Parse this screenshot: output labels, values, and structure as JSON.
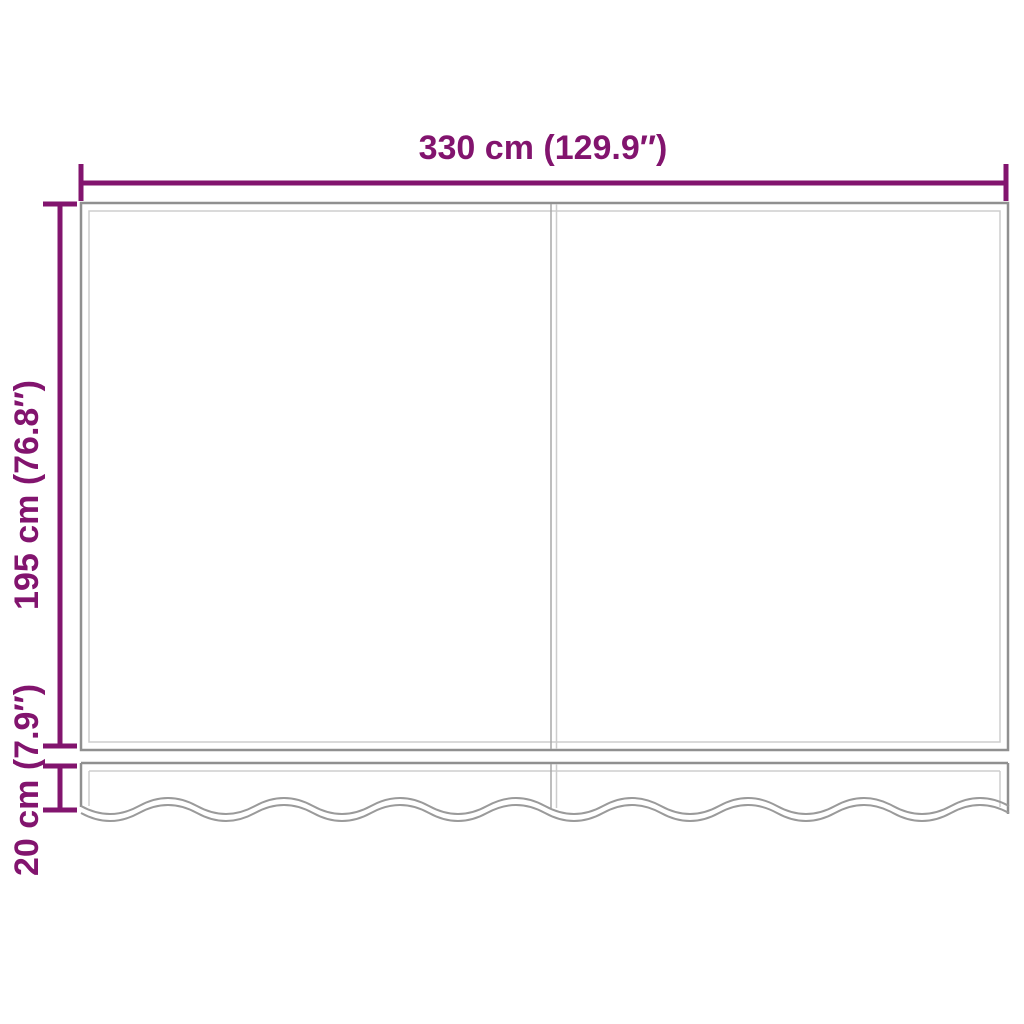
{
  "diagram": {
    "labels": {
      "width": "330 cm (129.9″)",
      "height": "195 cm (76.8″)",
      "valance_height": "20 cm (7.9″)"
    },
    "measurements": {
      "width_cm": 330,
      "width_inches": 129.9,
      "height_cm": 195,
      "height_inches": 76.8,
      "valance_height_cm": 20,
      "valance_height_inches": 7.9
    },
    "colors": {
      "dimension_accent": "#82146e",
      "outline_gray": "#909090",
      "inner_line_gray": "#cdcdcd",
      "divider_gray": "#a8a8a8",
      "wave_gray": "#9a9a9a",
      "background": "#ffffff"
    }
  }
}
